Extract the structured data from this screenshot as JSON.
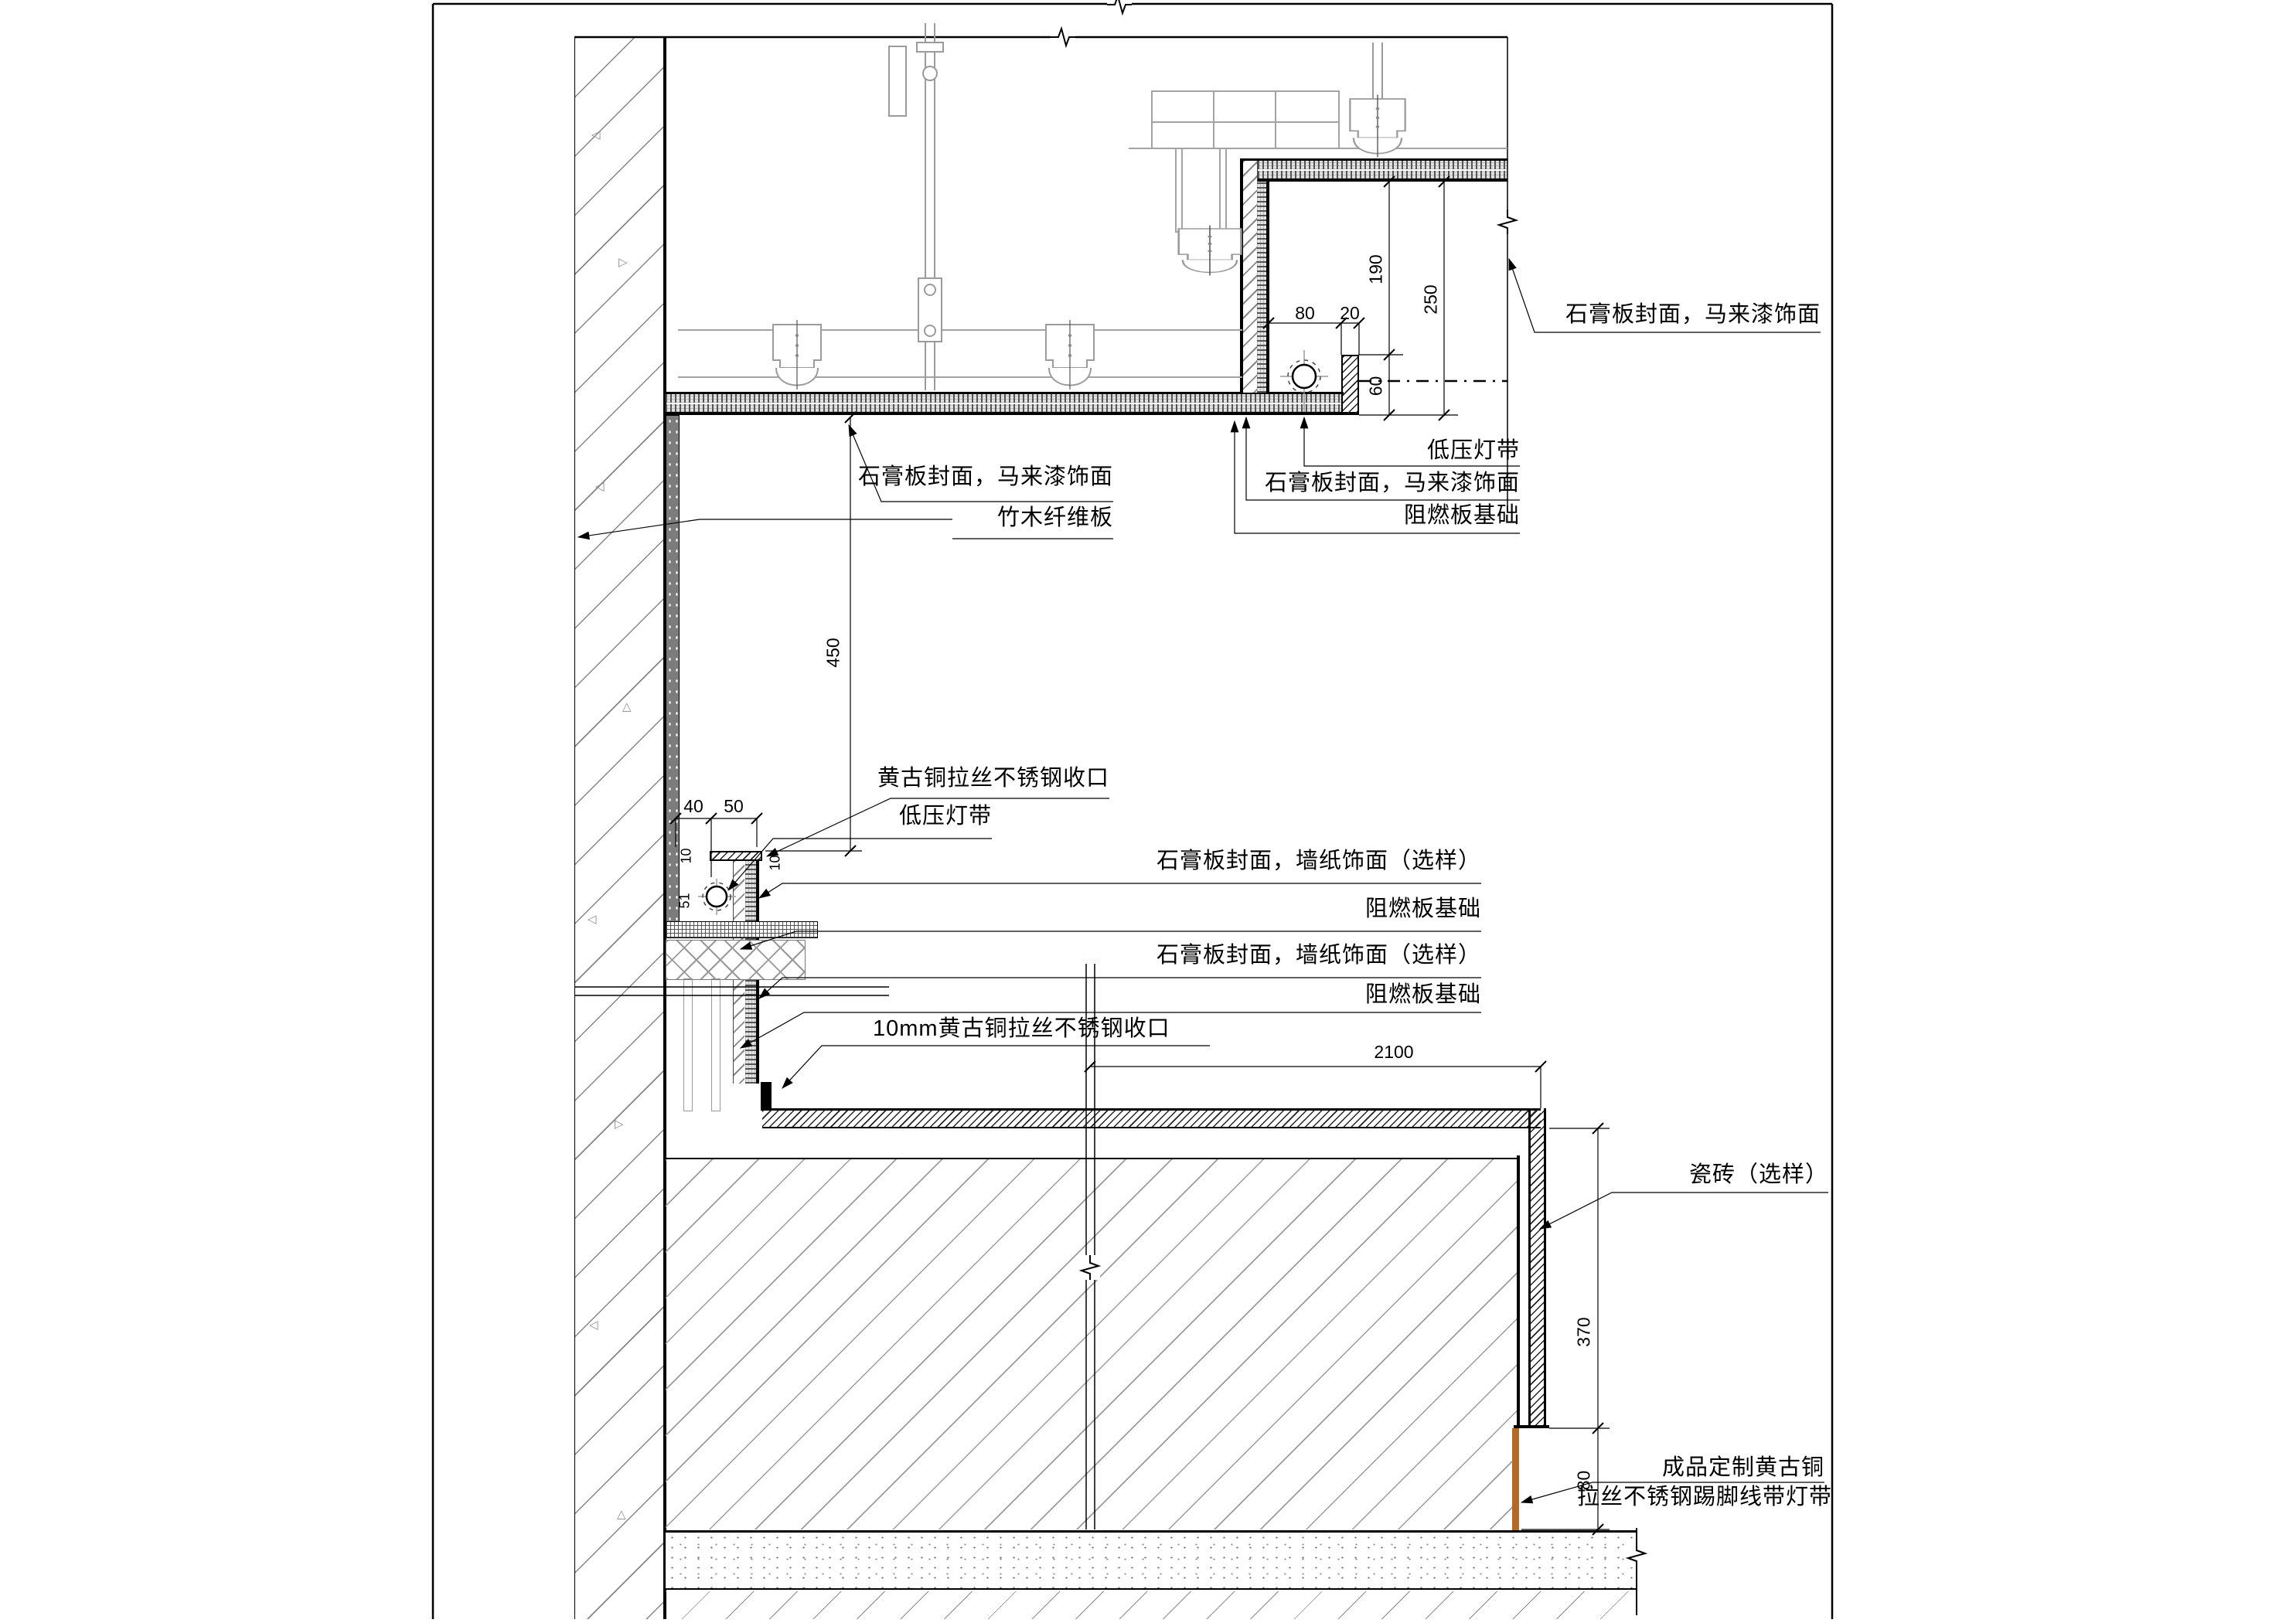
{
  "drawing": {
    "type": "interior construction detail section",
    "labels": {
      "ceil_left": "石膏板封面，马来漆饰面",
      "bamboo": "竹木纤维板",
      "pocket_top": "石膏板封面，马来漆饰面",
      "pocket_led": "低压灯带",
      "pocket_board": "石膏板封面，马来漆饰面",
      "pocket_fr": "阻燃板基础",
      "mid_trim": "黄古铜拉丝不锈钢收口",
      "mid_led": "低压灯带",
      "mid_board1": "石膏板封面，墙纸饰面（选样）",
      "mid_fr1": "阻燃板基础",
      "mid_board2": "石膏板封面，墙纸饰面（选样）",
      "mid_fr2": "阻燃板基础",
      "mid_trim10": "10mm黄古铜拉丝不锈钢收口",
      "tile": "瓷砖（选样）",
      "skirt_line1": "成品定制黄古铜",
      "skirt_line2": "拉丝不锈钢踢脚线带灯带"
    },
    "dimensions": {
      "d190": "190",
      "d250": "250",
      "d80_top": "80",
      "d20": "20",
      "d60": "60",
      "d450": "450",
      "d40": "40",
      "d50": "50",
      "d10_left": "10",
      "d51": "51",
      "d10_right": "10",
      "d2100": "2100",
      "d370": "370",
      "d80_bottom": "80"
    },
    "colors": {
      "line": "#000000",
      "gray": "#9b9b9b",
      "bronze_skirting": "#b06a2a",
      "paper": "#ffffff"
    }
  }
}
